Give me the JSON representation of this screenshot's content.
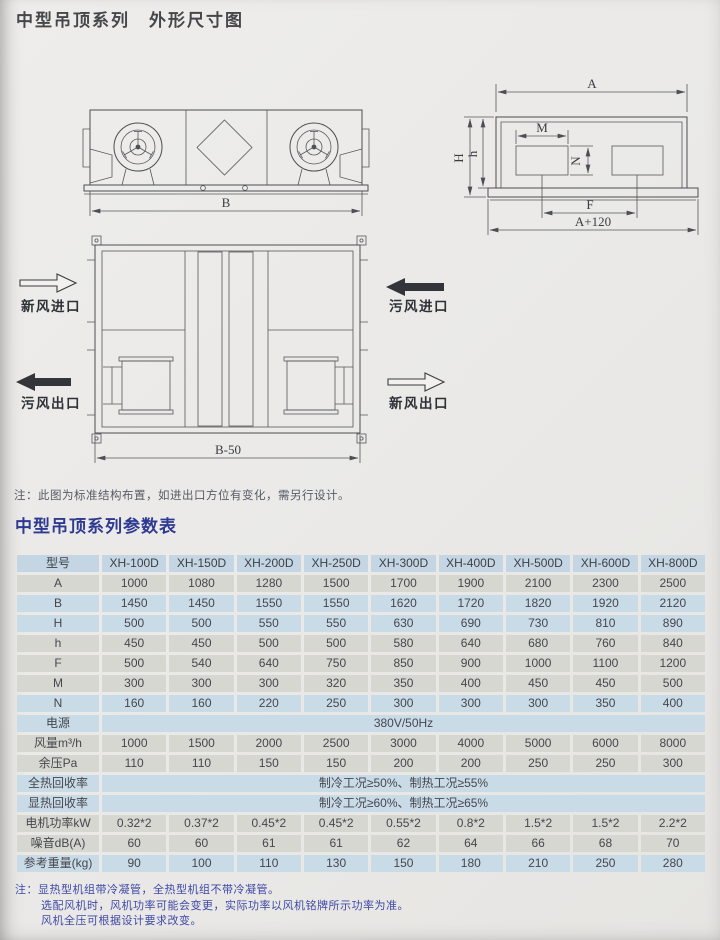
{
  "page": {
    "title": "中型吊顶系列　外形尺寸图",
    "note": "注：此图为标准结构布置，如进出口方位有变化，需另行设计。",
    "table_title": "中型吊顶系列参数表",
    "footnotes": [
      "注：显热型机组带冷凝管，全热型机组不带冷凝管。",
      "选配风机时，风机功率可能会变更，实际功率以风机铭牌所示功率为准。",
      "风机全压可根据设计要求改变。"
    ]
  },
  "colors": {
    "accent_blue_title": "#2e3a92",
    "footnote_blue": "#3e48a6",
    "table_header_blue": "#c4d6e4",
    "table_row_blue": "#cadbe8",
    "table_row_gray": "#d7d7d2",
    "paper": "#eae9e7",
    "line": "#4c4e54"
  },
  "diagrams": {
    "front_view": {
      "dim_b": "B"
    },
    "side_view": {
      "dim_a": "A",
      "dim_H": "H",
      "dim_h": "h",
      "dim_m": "M",
      "dim_n": "N",
      "dim_f": "F",
      "dim_a120": "A+120"
    },
    "top_view": {
      "dim_b50": "B-50",
      "labels": {
        "fresh_in": "新风进口",
        "foul_out": "污风出口",
        "foul_in": "污风进口",
        "fresh_out": "新风出口"
      }
    }
  },
  "table": {
    "header": [
      "型号",
      "XH-100D",
      "XH-150D",
      "XH-200D",
      "XH-250D",
      "XH-300D",
      "XH-400D",
      "XH-500D",
      "XH-600D",
      "XH-800D"
    ],
    "rows": [
      {
        "label": "A",
        "tint": "gray",
        "values": [
          "1000",
          "1080",
          "1280",
          "1500",
          "1700",
          "1900",
          "2100",
          "2300",
          "2500"
        ]
      },
      {
        "label": "B",
        "tint": "blue",
        "values": [
          "1450",
          "1450",
          "1550",
          "1550",
          "1620",
          "1720",
          "1820",
          "1920",
          "2120"
        ]
      },
      {
        "label": "H",
        "tint": "blue",
        "values": [
          "500",
          "500",
          "550",
          "550",
          "630",
          "690",
          "730",
          "810",
          "890"
        ]
      },
      {
        "label": "h",
        "tint": "gray",
        "values": [
          "450",
          "450",
          "500",
          "500",
          "580",
          "640",
          "680",
          "760",
          "840"
        ]
      },
      {
        "label": "F",
        "tint": "gray",
        "values": [
          "500",
          "540",
          "640",
          "750",
          "850",
          "900",
          "1000",
          "1100",
          "1200"
        ]
      },
      {
        "label": "M",
        "tint": "gray",
        "values": [
          "300",
          "300",
          "300",
          "320",
          "350",
          "400",
          "450",
          "450",
          "500"
        ]
      },
      {
        "label": "N",
        "tint": "blue",
        "values": [
          "160",
          "160",
          "220",
          "250",
          "300",
          "300",
          "300",
          "350",
          "400"
        ]
      },
      {
        "label": "电源",
        "tint": "blue",
        "span": "380V/50Hz"
      },
      {
        "label": "风量m³/h",
        "tint": "gray",
        "values": [
          "1000",
          "1500",
          "2000",
          "2500",
          "3000",
          "4000",
          "5000",
          "6000",
          "8000"
        ]
      },
      {
        "label": "余压Pa",
        "tint": "gray",
        "values": [
          "110",
          "110",
          "150",
          "150",
          "200",
          "200",
          "250",
          "250",
          "300"
        ]
      },
      {
        "label": "全热回收率",
        "tint": "blue",
        "span": "制冷工况≥50%、制热工况≥55%"
      },
      {
        "label": "显热回收率",
        "tint": "blue",
        "span": "制冷工况≥60%、制热工况≥65%"
      },
      {
        "label": "电机功率kW",
        "tint": "gray",
        "values": [
          "0.32*2",
          "0.37*2",
          "0.45*2",
          "0.45*2",
          "0.55*2",
          "0.8*2",
          "1.5*2",
          "1.5*2",
          "2.2*2"
        ]
      },
      {
        "label": "噪音dB(A)",
        "tint": "gray",
        "values": [
          "60",
          "60",
          "61",
          "61",
          "62",
          "64",
          "66",
          "68",
          "70"
        ]
      },
      {
        "label": "参考重量(kg)",
        "tint": "blue",
        "values": [
          "90",
          "100",
          "110",
          "130",
          "150",
          "180",
          "210",
          "250",
          "280"
        ]
      }
    ]
  }
}
